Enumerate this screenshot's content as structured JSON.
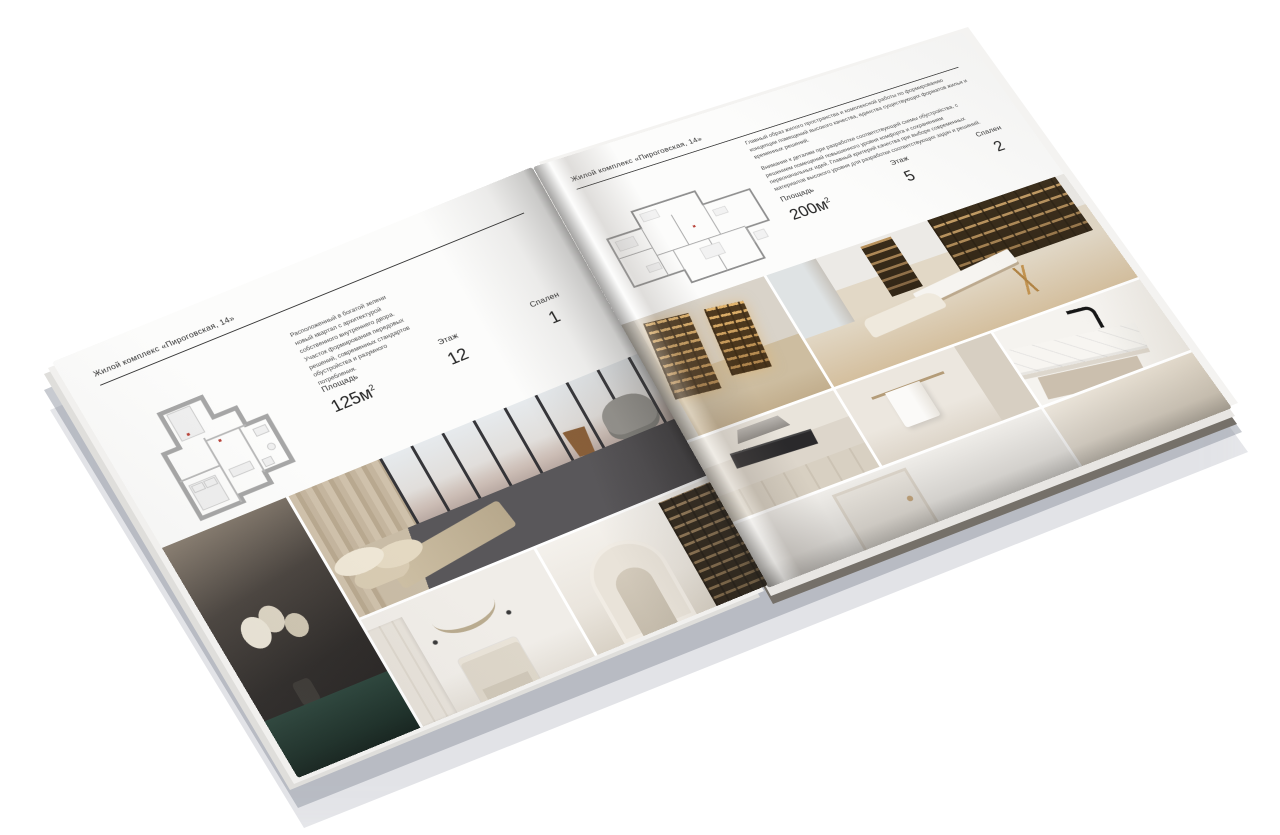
{
  "scene": {
    "background": "#ffffff",
    "shadow_color": "#8a909c"
  },
  "brochure": {
    "left_page": {
      "header": "Жилой комплекс «Пироговская, 14»",
      "description": "Расположенный в богатой зелени новый квартал с архитектурой собственного внутреннего двора. Участок формирования передовых решений, современных стандартов обустройства и разумного потребления.",
      "stats": [
        {
          "label": "Площадь",
          "value": "125м",
          "sup": "2"
        },
        {
          "label": "Этаж",
          "value": "12",
          "sup": ""
        },
        {
          "label": "Спален",
          "value": "1",
          "sup": ""
        }
      ],
      "floor_plan": "plan-125m2",
      "photos": [
        "dark-bedroom-with-flowers",
        "bedroom-with-city-windows",
        "white-bedroom-with-garland",
        "arched-corridor-with-bookshelf"
      ]
    },
    "right_page": {
      "header": "Жилой комплекс «Пироговская, 14»",
      "description_1": "Главный образ жилого пространства и комплексной работы по формированию концепции помещений высокого качества, единства существующих форматов жилья и временных решений.",
      "description_2": "Внимание к деталям при разработке соответствующей схемы обустройства, с решением помещений повышенного уровня комфорта и сохранением первоначальных идей. Главный критерий качества при выборе современных материалов высокого уровня для разработки соответствующих задач и решений.",
      "stats": [
        {
          "label": "Площадь",
          "value": "200м",
          "sup": "2"
        },
        {
          "label": "Этаж",
          "value": "5",
          "sup": ""
        },
        {
          "label": "Спален",
          "value": "2",
          "sup": ""
        }
      ],
      "floor_plan": "plan-200m2",
      "photos": [
        "corridor-with-lit-cabinets",
        "study-with-bookshelves-and-desk",
        "kitchen-with-dark-range",
        "bathroom-with-towel",
        "marble-sink-with-black-faucet",
        "white-room-with-door",
        "beige-room"
      ]
    }
  }
}
